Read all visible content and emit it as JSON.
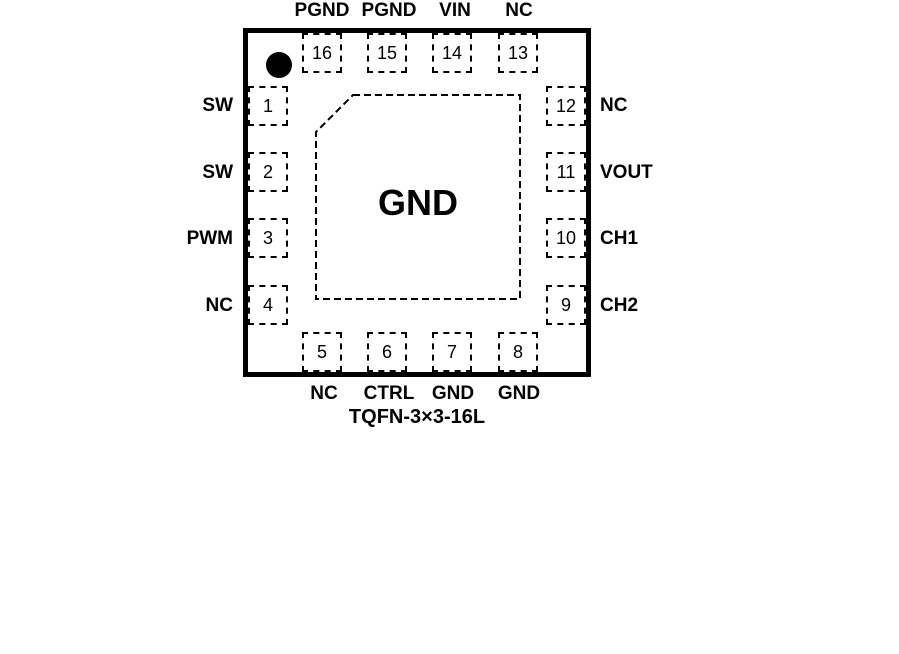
{
  "package": {
    "title": "TQFN-3×3-16L",
    "center_pad_label": "GND",
    "colors": {
      "line": "#000000",
      "background": "#ffffff"
    },
    "pins": {
      "top": [
        {
          "number": "16",
          "label": "PGND"
        },
        {
          "number": "15",
          "label": "PGND"
        },
        {
          "number": "14",
          "label": "VIN"
        },
        {
          "number": "13",
          "label": "NC"
        }
      ],
      "left": [
        {
          "number": "1",
          "label": "SW"
        },
        {
          "number": "2",
          "label": "SW"
        },
        {
          "number": "3",
          "label": "PWM"
        },
        {
          "number": "4",
          "label": "NC"
        }
      ],
      "right": [
        {
          "number": "12",
          "label": "NC"
        },
        {
          "number": "11",
          "label": "VOUT"
        },
        {
          "number": "10",
          "label": "CH1"
        },
        {
          "number": "9",
          "label": "CH2"
        }
      ],
      "bottom": [
        {
          "number": "5",
          "label": "NC"
        },
        {
          "number": "6",
          "label": "CTRL"
        },
        {
          "number": "7",
          "label": "GND"
        },
        {
          "number": "8",
          "label": "GND"
        }
      ]
    }
  }
}
